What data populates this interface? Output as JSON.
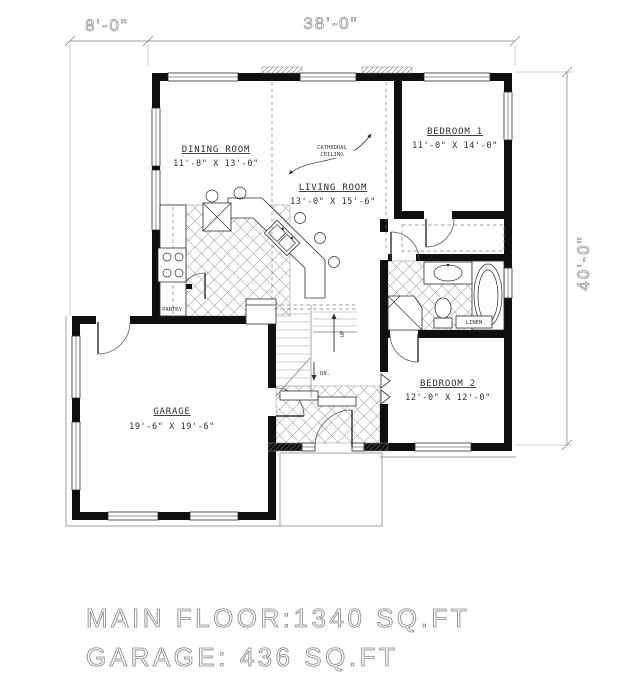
{
  "title": "House main floor plan",
  "dimensions": {
    "top_left": "8'-0\"",
    "top_main": "38'-0\"",
    "right": "40'-0\""
  },
  "rooms": {
    "dining": {
      "name": "DINING ROOM",
      "size": "11'-8\" X 13'-0\""
    },
    "living": {
      "name": "LIVING ROOM",
      "size": "13'-0\" X 15'-6\""
    },
    "bedroom1": {
      "name": "BEDROOM 1",
      "size": "11'-0\" X 14'-0\""
    },
    "bedroom2": {
      "name": "BEDROOM 2",
      "size": "12'-0\" X 12'-0\""
    },
    "garage": {
      "name": "GARAGE",
      "size": "19'-6\" X 19'-6\""
    }
  },
  "labels": {
    "pantry": "PANTRY",
    "linen": "LINEN",
    "up": "UP",
    "dn": "DN.",
    "cathedral_line1": "CATHEDRAL",
    "cathedral_line2": "CEILING"
  },
  "footer": {
    "line1": "MAIN FLOOR:1340 SQ.FT",
    "line2": "GARAGE:  436 SQ.FT"
  },
  "colors": {
    "wall": "#0f0f0f",
    "line_gray": "#7d7d7d",
    "dim_gray": "#8e8e8e",
    "paper": "#ffffff"
  }
}
